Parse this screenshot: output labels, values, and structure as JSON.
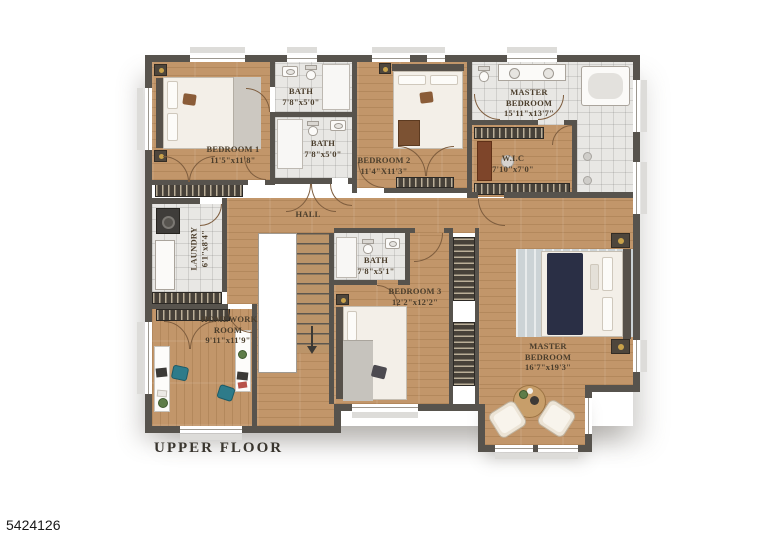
{
  "meta": {
    "floor_caption": "UPPER FLOOR",
    "listing_number": "5424126"
  },
  "colors": {
    "wall": "#57534d",
    "wood_floor": "#c2966a",
    "tile_floor": "#e8e7e4",
    "label_text": "#4b3e2c",
    "accent_navy": "#2a2f45",
    "accent_teal": "#2e7b8a"
  },
  "rooms": [
    {
      "id": "bedroom_1",
      "name": "BEDROOM 1",
      "dims": "11'5\"x11'8\""
    },
    {
      "id": "bath_top",
      "name": "BATH",
      "dims": "7'8\"x5'0\""
    },
    {
      "id": "bath_middle",
      "name": "BATH",
      "dims": "7'8\"x5'0\""
    },
    {
      "id": "bedroom_2",
      "name": "BEDROOM 2",
      "dims": "11'4\"X11'3\""
    },
    {
      "id": "master_bath",
      "name": "MASTER BEDROOM",
      "dims": "15'11\"x13'7\""
    },
    {
      "id": "walk_in_closet",
      "name": "W.I.C",
      "dims": "7'10\"x7'0\""
    },
    {
      "id": "laundry",
      "name": "LAUNDRY",
      "dims": "6'1\"x8'4\""
    },
    {
      "id": "hall",
      "name": "HALL",
      "dims": ""
    },
    {
      "id": "bath_lower",
      "name": "BATH",
      "dims": "7'8\"x5'1\""
    },
    {
      "id": "bedroom_3",
      "name": "BEDROOM 3",
      "dims": "12'2\"x12'2\""
    },
    {
      "id": "homework_room",
      "name": "HOMEWORK ROOM",
      "dims": "9'11\"x11'9\""
    },
    {
      "id": "master_bedroom",
      "name": "MASTER BEDROOM",
      "dims": "16'7\"x19'3\""
    }
  ]
}
